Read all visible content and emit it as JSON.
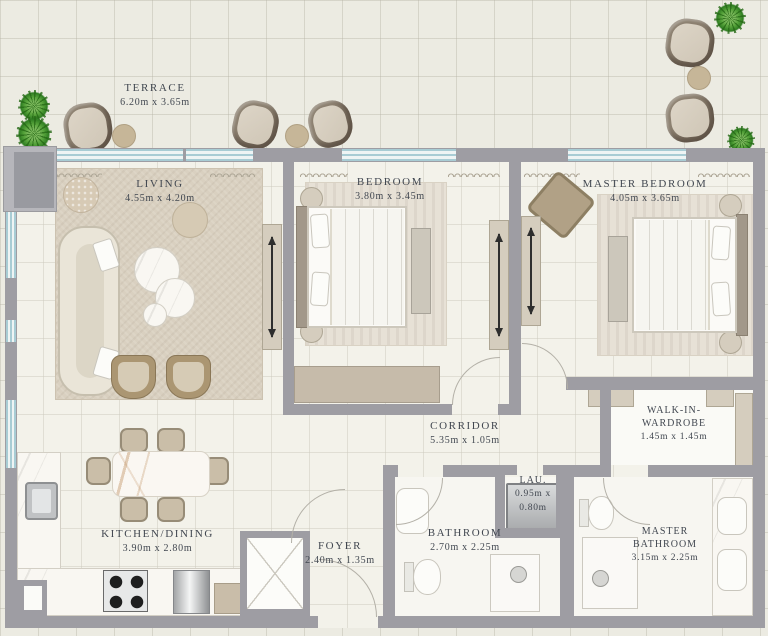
{
  "labels": {
    "terrace": {
      "name": "TERRACE",
      "dims": "6.20m x 3.65m"
    },
    "living": {
      "name": "LIVING",
      "dims": "4.55m x 4.20m"
    },
    "bedroom": {
      "name": "BEDROOM",
      "dims": "3.80m x 3.45m"
    },
    "master_bedroom": {
      "name": "MASTER BEDROOM",
      "dims": "4.05m x 3.65m"
    },
    "corridor": {
      "name": "CORRIDOR",
      "dims": "5.35m x 1.05m"
    },
    "walk_in_wardrobe": {
      "name_line1": "WALK-IN-",
      "name_line2": "WARDROBE",
      "dims": "1.45m x 1.45m"
    },
    "laundry": {
      "name": "LAU.",
      "dims_line1": "0.95m x",
      "dims_line2": "0.80m"
    },
    "kitchen_dining": {
      "name": "KITCHEN/DINING",
      "dims": "3.90m x 2.80m"
    },
    "foyer": {
      "name": "FOYER",
      "dims": "2.40m x 1.35m"
    },
    "bathroom": {
      "name": "BATHROOM",
      "dims": "2.70m x 2.25m"
    },
    "master_bathroom": {
      "name_line1": "MASTER",
      "name_line2": "BATHROOM",
      "dims": "3.15m x 2.25m"
    }
  },
  "colors": {
    "wall": "#9e9da3",
    "window_line": "#a8ccd4",
    "floor_interior": "#f3f2ea",
    "floor_terrace": "#ecebe2",
    "rug_beige": "#d9d0c0",
    "furniture_beige": "#d5cdbe",
    "furniture_brown": "#ab9672",
    "marble": "#f9f7f2",
    "plant_green": "#55a23a",
    "label_text": "#414750"
  }
}
